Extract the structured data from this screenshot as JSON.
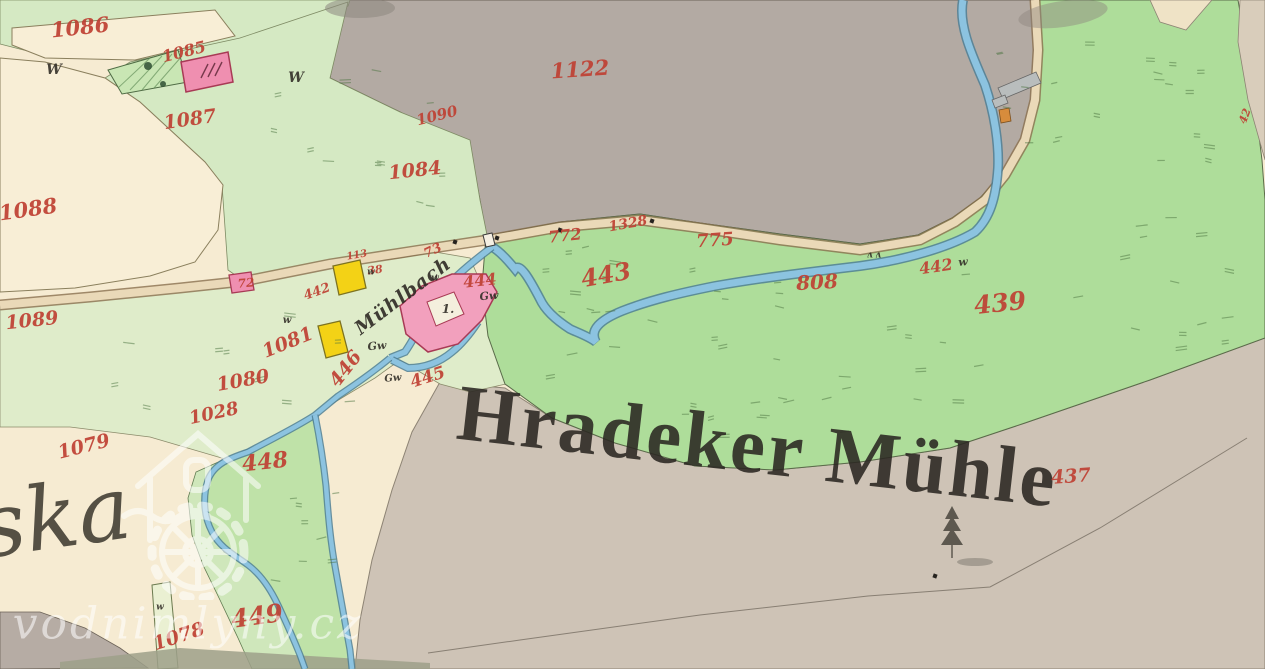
{
  "map": {
    "title": "Hradeker Mühle",
    "stream_label": "Mühlbach",
    "place_fragment": "ska",
    "watermark": {
      "text": "vodnimlyny.cz",
      "logo": "watermill-house-logo"
    },
    "colors": {
      "field_cream": "#f6ebd2",
      "meadow_pale": "#d5e9c3",
      "meadow_green": "#aedd9a",
      "forest_gray": "#b3aaa3",
      "heath_beige": "#cec3b6",
      "water_blue": "#8cc3e0",
      "water_edge": "#4e7f95",
      "road_beige": "#ead9b8",
      "building_masonry_pink": "#ef8fb0",
      "building_wood_yellow": "#f3d216",
      "parcel_number_red": "#bf4033",
      "ink_black": "#332f28"
    },
    "labels": {
      "red": [
        {
          "t": "1086",
          "x": 80,
          "y": 27,
          "r": -6,
          "s": 21
        },
        {
          "t": "1085",
          "x": 184,
          "y": 52,
          "r": -14,
          "s": 16
        },
        {
          "t": "1087",
          "x": 190,
          "y": 120,
          "r": -8,
          "s": 19
        },
        {
          "t": "1122",
          "x": 580,
          "y": 69,
          "r": -4,
          "s": 21
        },
        {
          "t": "1090",
          "x": 437,
          "y": 116,
          "r": -14,
          "s": 15
        },
        {
          "t": "1084",
          "x": 415,
          "y": 171,
          "r": -6,
          "s": 19
        },
        {
          "t": "1088",
          "x": 28,
          "y": 209,
          "r": -8,
          "s": 21
        },
        {
          "t": "1089",
          "x": 32,
          "y": 321,
          "r": -6,
          "s": 19
        },
        {
          "t": "1081",
          "x": 288,
          "y": 343,
          "r": -22,
          "s": 19
        },
        {
          "t": "1080",
          "x": 243,
          "y": 381,
          "r": -10,
          "s": 19
        },
        {
          "t": "1028",
          "x": 214,
          "y": 414,
          "r": -12,
          "s": 18
        },
        {
          "t": "1079",
          "x": 84,
          "y": 447,
          "r": -14,
          "s": 19
        },
        {
          "t": "1078",
          "x": 179,
          "y": 637,
          "r": -18,
          "s": 19
        },
        {
          "t": "448",
          "x": 265,
          "y": 462,
          "r": -6,
          "s": 22
        },
        {
          "t": "449",
          "x": 257,
          "y": 616,
          "r": -8,
          "s": 25
        },
        {
          "t": "443",
          "x": 606,
          "y": 275,
          "r": -10,
          "s": 24
        },
        {
          "t": "444",
          "x": 480,
          "y": 281,
          "r": -6,
          "s": 16
        },
        {
          "t": "445",
          "x": 428,
          "y": 378,
          "r": -18,
          "s": 17
        },
        {
          "t": "446",
          "x": 346,
          "y": 369,
          "r": -52,
          "s": 19
        },
        {
          "t": "772",
          "x": 565,
          "y": 236,
          "r": -6,
          "s": 16
        },
        {
          "t": "1328",
          "x": 628,
          "y": 224,
          "r": -10,
          "s": 14
        },
        {
          "t": "775",
          "x": 715,
          "y": 241,
          "r": -4,
          "s": 18
        },
        {
          "t": "808",
          "x": 817,
          "y": 282,
          "r": -3,
          "s": 20
        },
        {
          "t": "442",
          "x": 936,
          "y": 267,
          "r": -8,
          "s": 16
        },
        {
          "t": "439",
          "x": 1000,
          "y": 303,
          "r": -6,
          "s": 25
        },
        {
          "t": "437",
          "x": 1071,
          "y": 477,
          "r": -4,
          "s": 19
        },
        {
          "t": "113",
          "x": 357,
          "y": 256,
          "r": -10,
          "s": 10
        },
        {
          "t": "38",
          "x": 375,
          "y": 270,
          "r": -8,
          "s": 11
        },
        {
          "t": "442",
          "x": 317,
          "y": 292,
          "r": -20,
          "s": 13
        },
        {
          "t": "73",
          "x": 433,
          "y": 251,
          "r": -25,
          "s": 13
        },
        {
          "t": "72",
          "x": 246,
          "y": 283,
          "r": -5,
          "s": 12
        },
        {
          "t": "42",
          "x": 1245,
          "y": 116,
          "r": -70,
          "s": 11
        }
      ],
      "black": [
        {
          "t": "W",
          "x": 54,
          "y": 70,
          "r": 0,
          "s": 14
        },
        {
          "t": "W",
          "x": 296,
          "y": 78,
          "r": 0,
          "s": 14
        },
        {
          "t": "w",
          "x": 287,
          "y": 321,
          "r": 0,
          "s": 10
        },
        {
          "t": "w",
          "x": 371,
          "y": 273,
          "r": 0,
          "s": 9
        },
        {
          "t": "w",
          "x": 435,
          "y": 279,
          "r": 0,
          "s": 9
        },
        {
          "t": "w",
          "x": 963,
          "y": 262,
          "r": -5,
          "s": 11
        },
        {
          "t": "Gw",
          "x": 489,
          "y": 296,
          "r": -5,
          "s": 11
        },
        {
          "t": "Gw",
          "x": 377,
          "y": 346,
          "r": -5,
          "s": 11
        },
        {
          "t": "Gw",
          "x": 393,
          "y": 379,
          "r": -5,
          "s": 10
        },
        {
          "t": "1.",
          "x": 448,
          "y": 309,
          "r": 0,
          "s": 12
        },
        {
          "t": "w",
          "x": 160,
          "y": 608,
          "r": 0,
          "s": 9
        },
        {
          "t": "ʌ ʌ",
          "x": 874,
          "y": 256,
          "r": 0,
          "s": 9
        }
      ]
    },
    "markers": [
      {
        "x": 455,
        "y": 242
      },
      {
        "x": 560,
        "y": 230
      },
      {
        "x": 652,
        "y": 221
      },
      {
        "x": 497,
        "y": 238
      },
      {
        "x": 935,
        "y": 576
      }
    ]
  }
}
